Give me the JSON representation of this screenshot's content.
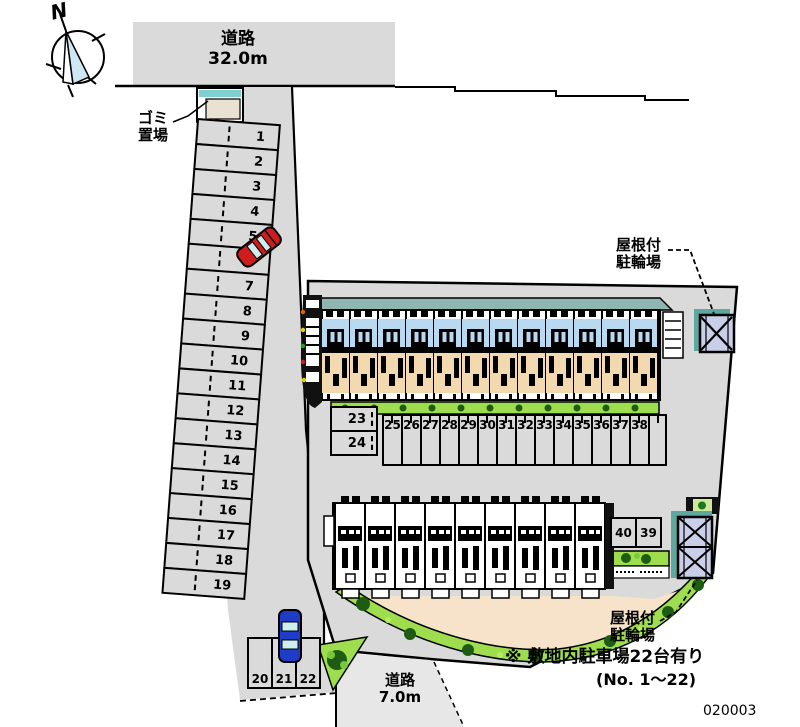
{
  "compass": {
    "north": "N"
  },
  "roads": {
    "top": {
      "name": "道路",
      "width": "32.0m"
    },
    "bottom": {
      "name": "道路",
      "width": "7.0m"
    }
  },
  "facilities": {
    "garbage": {
      "line1": "ゴミ",
      "line2": "置場"
    },
    "bike_top": {
      "line1": "屋根付",
      "line2": "駐輪場"
    },
    "bike_bottom": {
      "line1": "屋根付",
      "line2": "駐輪場"
    }
  },
  "notes": {
    "line1": "※ 敷地内駐車場22台有り",
    "line2": "(No. 1～22)",
    "plan_no": "020003"
  },
  "parking": {
    "left_column": [
      "1",
      "2",
      "3",
      "4",
      "5",
      "6",
      "7",
      "8",
      "9",
      "10",
      "11",
      "12",
      "13",
      "14",
      "15",
      "16",
      "17",
      "18",
      "19"
    ],
    "bottom_row": [
      "20",
      "21",
      "22"
    ],
    "mid_left": [
      "23",
      "24"
    ],
    "mid_row": [
      "25",
      "26",
      "27",
      "28",
      "29",
      "30",
      "31",
      "32",
      "33",
      "34",
      "35",
      "36",
      "37",
      "38"
    ],
    "right_pair": [
      "40",
      "39"
    ]
  },
  "colors": {
    "site_gray": "#dadada",
    "roof_teal": "#8fb6b0",
    "balcony_blue": "#b9d9f1",
    "room_tan": "#f2d9b0",
    "lawn_green": "#9ede4e",
    "tree_green": "#1d5c12",
    "open_area_tan": "#f6e3c9",
    "bike_shed_fill": "#c9cfe8",
    "garbage_teal": "#7fd0d0",
    "car_red": "#cf1d1d",
    "car_blue": "#1e3cc8"
  }
}
